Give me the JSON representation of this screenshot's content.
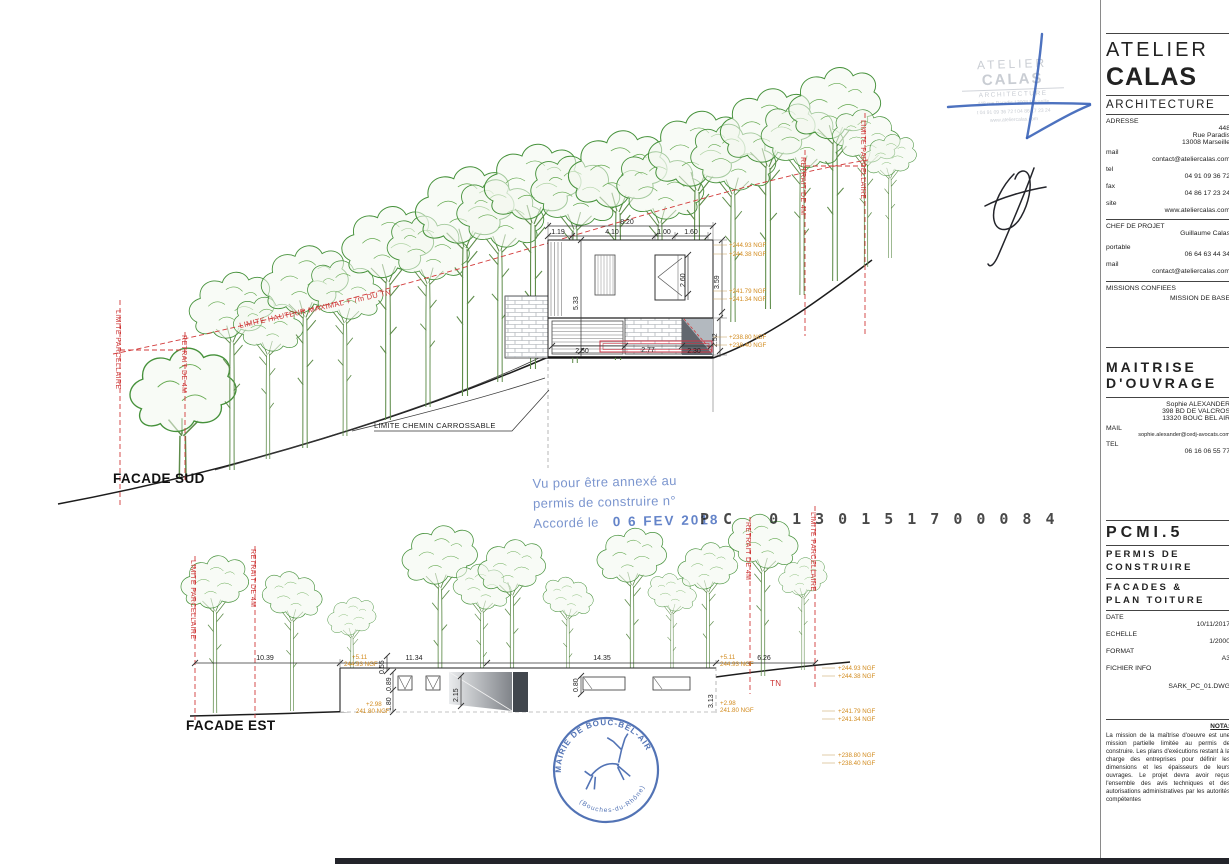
{
  "titleblock": {
    "logo_line1": "ATELIER",
    "logo_line2": "CALAS",
    "logo_line3": "ARCHITECTURE",
    "adresse_label": "ADRESSE",
    "adresse_l1": "448",
    "adresse_l2": "Rue Paradis",
    "adresse_l3": "13008 Marseille",
    "mail_label": "mail",
    "mail_value": "contact@ateliercalas.com",
    "tel_label": "tel",
    "tel_value": "04 91 09 36 72",
    "fax_label": "fax",
    "fax_value": "04 86 17 23 24",
    "site_label": "site",
    "site_value": "www.ateliercalas.com",
    "chef_label": "CHEF DE PROJET",
    "chef_value": "Guillaume Calas",
    "portable_label": "portable",
    "portable_value": "06 64 63 44 34",
    "mail2_label": "mail",
    "mail2_value": "contact@ateliercalas.com",
    "missions_label": "MISSIONS CONFIEES",
    "missions_value": "MISSION DE BASE",
    "moa_line1": "MAITRISE",
    "moa_line2": "D'OUVRAGE",
    "moa_name": "Sophie ALEXANDER",
    "moa_addr1": "398 BD DE VALCROS",
    "moa_addr2": "13320 BOUC BEL AIR",
    "moa_mail_label": "MAIL",
    "moa_mail": "sophie.alexander@cedj-avocats.com",
    "moa_tel_label": "TEL",
    "moa_tel": "06 16 06 55 77",
    "piece_code": "PCMI.5",
    "permis_l1": "PERMIS DE",
    "permis_l2": "CONSTRUIRE",
    "facades_l1": "FACADES &",
    "facades_l2": "PLAN TOITURE",
    "date_label": "DATE",
    "date_value": "10/11/2017",
    "echelle_label": "ECHELLE",
    "echelle_value": "1/2000",
    "format_label": "FORMAT",
    "format_value": "A3",
    "fichier_label": "FICHIER INFO",
    "fichier_value": "SARK_PC_01.DWG",
    "nota_label": "NOTA:",
    "nota_text": "La mission de la maîtrise d'oeuvre est une mission partielle limitée au permis de construire. Les plans d'exécutions restant à la charge des entreprises pour définir les dimensions et les épaisseurs de leurs ouvrages. Le projet devra avoir reçus l'ensemble des avis techniques et des autorisations administratives par les autorités compétentes"
  },
  "ghost_stamp": {
    "l1": "ATELIER",
    "l2": "CALAS",
    "l3": "ARCHITECTURE",
    "l4": "448 rue Paradis 13008 Marseille",
    "l5": "t 04 91 09 36 72  f 04 86 17 23 24",
    "l6": "www.ateliercalas.com"
  },
  "approval": {
    "l1": "Vu pour être annexé au",
    "l2": "permis de construire n°",
    "l3": "Accordé le",
    "date": "0 6 FEV 2018",
    "pc": "PC 0130151700084"
  },
  "mairie": {
    "arc_top": "MAIRIE DE BOUC-BEL-AIR",
    "arc_bottom": "(Bouches-du-Rhône)"
  },
  "facade_sud": {
    "label": "FACADE SUD",
    "dim_total": "8.20",
    "dt0": "1.19",
    "dt1": "4.10",
    "dt2": "1.00",
    "dt3": "1.60",
    "dv_left": "5.33",
    "dv_win": "2.60",
    "dv_r1": "3.59",
    "dv_r2": "2.52",
    "db0": "2.50",
    "db1": "2.77",
    "db2": "2.30",
    "lv0": "+244.93 NGF",
    "lv1": "+244.38 NGF",
    "lv2": "+241.79 NGF",
    "lv3": "+241.34 NGF",
    "lv4": "+238.80 NGF",
    "lv5": "+238.40 NGF",
    "lim_parc_l": "LIMITE PARCELLAIRE",
    "retrait_l": "RETRAIT DE 4M",
    "lim_haut": "LIMITE HAUTEUR MAXIMAL + 7m DU TN",
    "retrait_r": "RETRAIT DE 4M",
    "lim_parc_r": "LIMITE PARCELLAIRE",
    "chemin": "LIMITE CHEMIN CARROSSABLE"
  },
  "facade_est": {
    "label": "FACADE EST",
    "d1": "10.39",
    "d2": "11.34",
    "d3": "14.35",
    "d4": "6.26",
    "v1": "0.55",
    "v2": "0.89",
    "v3": "1.80",
    "v4": "2.15",
    "v5": "0.80",
    "v6": "3.13",
    "sp_top": "+5.11",
    "sp_top_ngf": "244.93 NGF",
    "sp_bot": "+2.98",
    "sp_bot_ngf": "241.80 NGF",
    "tn": "TN",
    "lv0": "+244.93 NGF",
    "lv1": "+244.38 NGF",
    "lv2": "+241.79 NGF",
    "lv3": "+241.34 NGF",
    "lv4": "+238.80 NGF",
    "lv5": "+238.40 NGF",
    "lim_parc_l": "LIMITE PARCELLAIRE",
    "retrait_l": "RETRAIT DE 4M",
    "retrait_r": "RETRAIT DE 4M",
    "lim_parc_r": "LIMITE PARCELLAIRE"
  }
}
